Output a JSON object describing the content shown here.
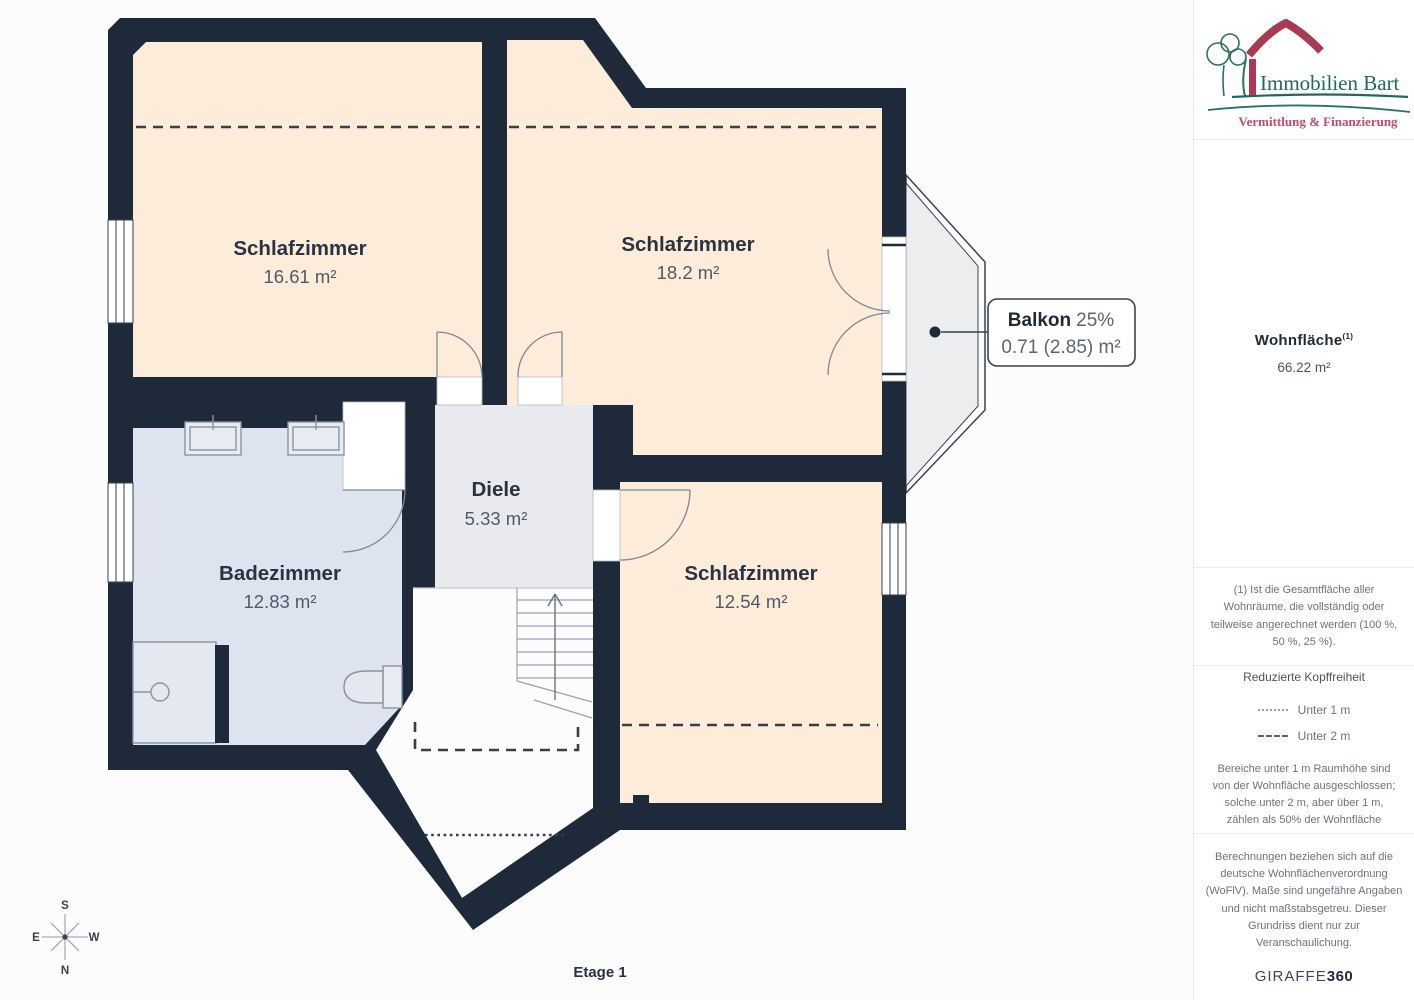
{
  "plan": {
    "rooms": [
      {
        "name": "Schlafzimmer",
        "area": "16.61 m²"
      },
      {
        "name": "Schlafzimmer",
        "area": "18.2 m²"
      },
      {
        "name": "Schlafzimmer",
        "area": "12.54 m²"
      },
      {
        "name": "Badezimmer",
        "area": "12.83 m²"
      },
      {
        "name": "Diele",
        "area": "5.33 m²"
      }
    ],
    "balcony": {
      "label": "Balkon",
      "percent": "25%",
      "area": "0.71 (2.85) m²"
    },
    "floor_label": "Etage 1",
    "compass": {
      "n": "N",
      "s": "S",
      "e": "E",
      "w": "W"
    },
    "colors": {
      "wall": "#1e2a39",
      "bedroom": "#fcecd9",
      "bathroom": "#dee4ef",
      "hall": "#e8eaee",
      "balcony": "#ecedee"
    }
  },
  "sidebar": {
    "logo": {
      "title": "Immobilien Bart",
      "subtitle": "Vermittlung & Finanzierung"
    },
    "wohnflaeche": {
      "label": "Wohnfläche",
      "footnote_marker": "(1)",
      "value": "66.22 m²"
    },
    "footnote": "(1) Ist die Gesamtfläche aller\nWohnräume, die vollständig oder\nteilweise angerechnet werden (100 %,\n50 %, 25 %).",
    "kopffreiheit": {
      "title": "Reduzierte Kopffreiheit",
      "legend": [
        {
          "style": "dotted",
          "label": "Unter 1 m"
        },
        {
          "style": "dashed",
          "label": "Unter 2 m"
        }
      ],
      "text": "Bereiche unter 1 m Raumhöhe sind\nvon der Wohnfläche ausgeschlossen;\nsolche unter 2 m, aber über 1 m,\nzählen als 50% der Wohnfläche"
    },
    "disclaimer": "Berechnungen beziehen sich auf die\ndeutsche Wohnflächenverordnung\n(WoFlV). Maße sind ungefähre Angaben\nund nicht maßstabsgetreu. Dieser\nGrundriss dient nur zur\nVeranschaulichung.",
    "brand": {
      "name": "GIRAFFE",
      "suffix": "360"
    }
  }
}
